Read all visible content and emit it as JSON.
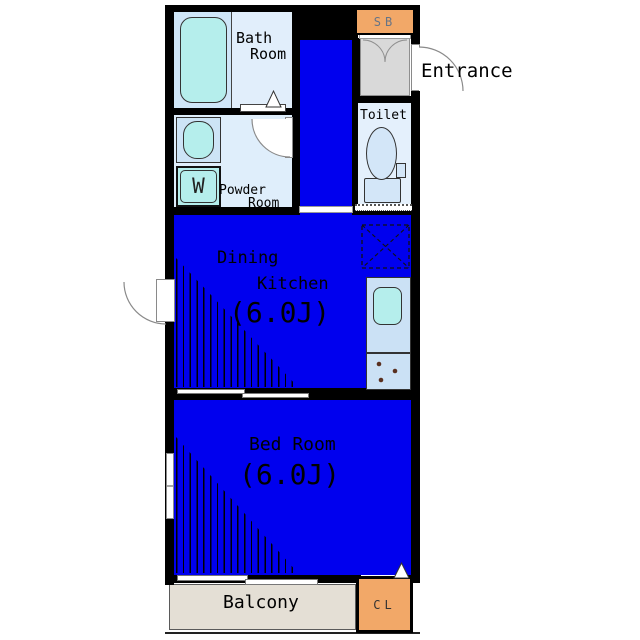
{
  "labels": {
    "bath_line1": "Bath",
    "bath_line2": "Room",
    "powder_line1": "Powder",
    "powder_line2": "Room",
    "toilet": "Toilet",
    "entrance": "Entrance",
    "dk_line1": "Dining",
    "dk_line2": "Kitchen",
    "dk_size": "(6.0J)",
    "bed": "Bed Room",
    "bed_size": "(6.0J)",
    "balcony": "Balcony",
    "shoe_box": "SB",
    "closet": "CL",
    "washer": "W"
  },
  "colors": {
    "room_blue": "#0000ee",
    "light_blue": "#dfeefb",
    "fixture_cyan": "#b5eeec",
    "counter_blue": "#cbe1f5",
    "orange": "#f2a868",
    "entrance_gray": "#d9d9d9",
    "balcony_beige": "#e4dfd5",
    "wall_black": "#000000"
  }
}
